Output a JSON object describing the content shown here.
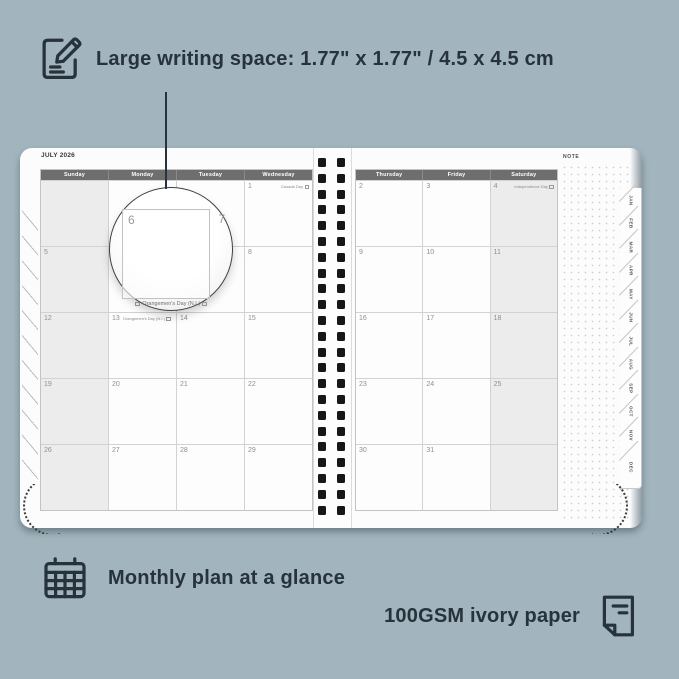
{
  "colors": {
    "background": "#a2b4bd",
    "ink": "#26323c",
    "header_bg": "#6e6e6e",
    "weekend_bg": "#ececec",
    "page": "#fcfcfc"
  },
  "annotations": {
    "top": {
      "icon": "edit-note-icon",
      "text": "Large writing space: 1.77\" x 1.77\" / 4.5 x 4.5 cm"
    },
    "bottom_left": {
      "icon": "calendar-grid-icon",
      "text": "Monthly plan at a glance"
    },
    "bottom_right": {
      "icon": "paper-sheet-icon",
      "text": "100GSM ivory paper"
    }
  },
  "planner": {
    "month_title": "JULY 2026",
    "note_label": "NOTE",
    "spiral_holes_per_column": 23,
    "left_page": {
      "headers": [
        "Sunday",
        "Monday",
        "Tuesday",
        "Wednesday"
      ],
      "weekend_column": 0,
      "rows": [
        [
          "",
          "",
          "",
          {
            "d": "1",
            "h": "Canada Day"
          }
        ],
        [
          "5",
          "6",
          "7",
          "8"
        ],
        [
          "12",
          {
            "d": "13",
            "h": "Orangemen's Day (N.I.)",
            "align": "left"
          },
          "14",
          "15"
        ],
        [
          "19",
          "20",
          "21",
          "22"
        ],
        [
          "26",
          "27",
          "28",
          "29"
        ]
      ]
    },
    "right_page": {
      "headers": [
        "Thursday",
        "Friday",
        "Saturday"
      ],
      "weekend_column": 2,
      "rows": [
        [
          "2",
          "3",
          {
            "d": "4",
            "h": "Independence Day"
          }
        ],
        [
          "9",
          "10",
          "11"
        ],
        [
          "16",
          "17",
          "18"
        ],
        [
          "23",
          "24",
          "25"
        ],
        [
          "30",
          "31",
          ""
        ]
      ]
    },
    "month_tabs": [
      "JAN",
      "FEB",
      "MAR",
      "APR",
      "MAY",
      "JUN",
      "JUL",
      "AUG",
      "SEP",
      "OCT",
      "NOV",
      "DEC"
    ],
    "magnifier": {
      "left_day": "6",
      "right_day": "7",
      "holiday": "Orangemen's Day (N.I.)"
    }
  }
}
